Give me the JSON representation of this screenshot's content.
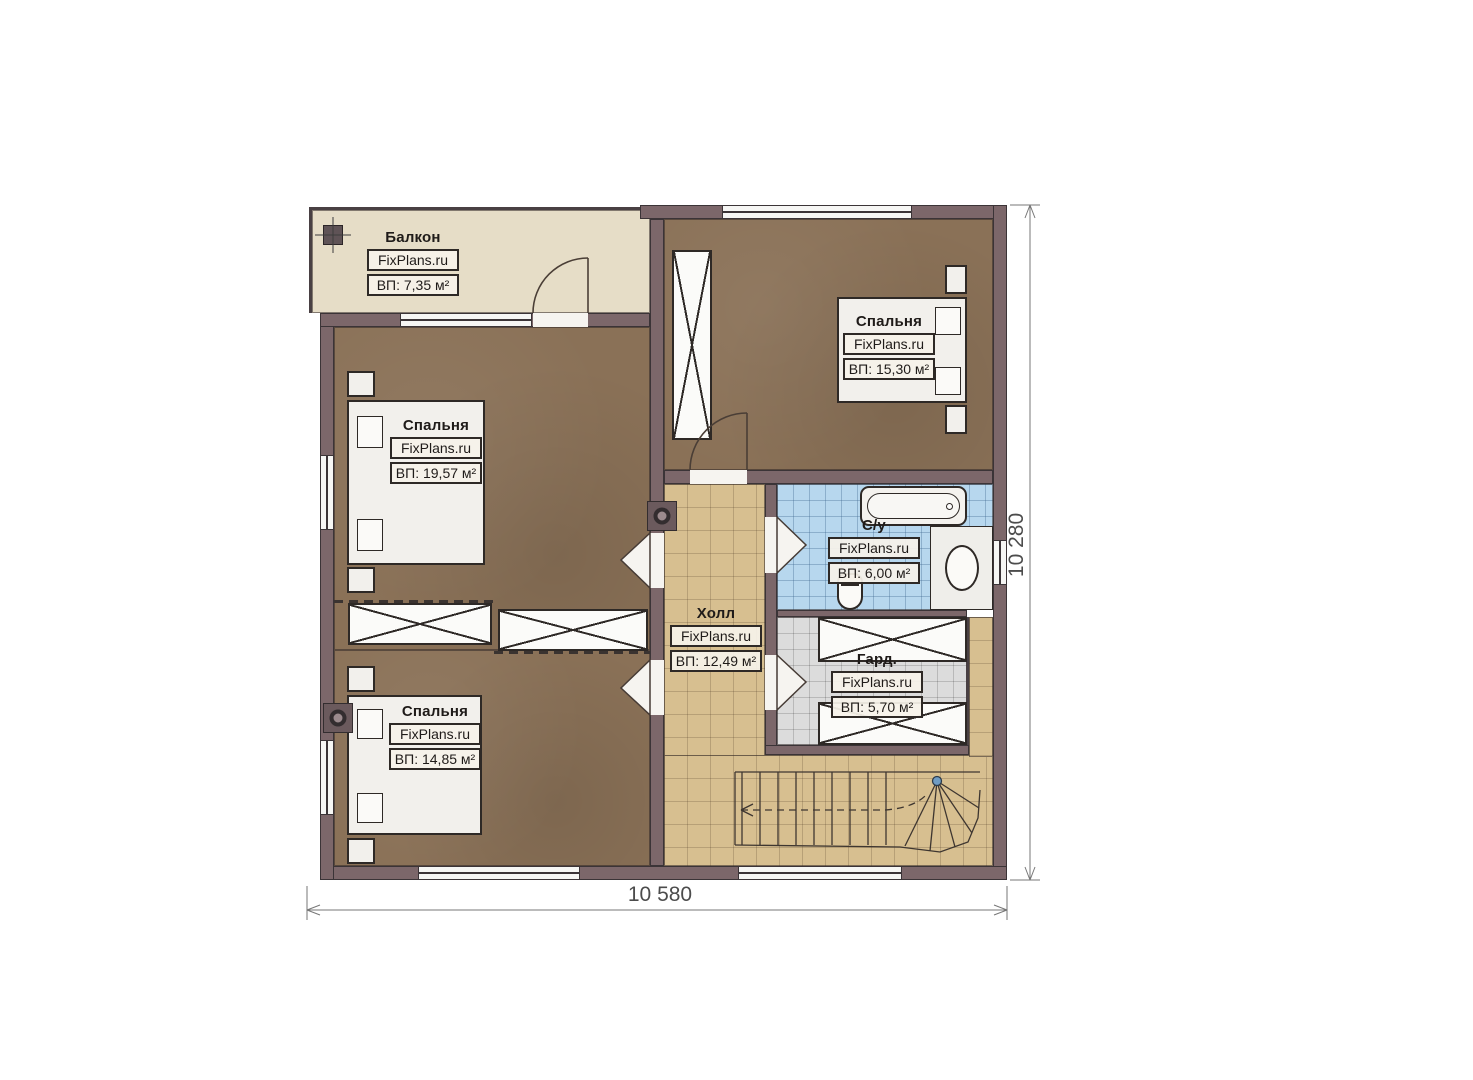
{
  "plan_title": "Floor plan — second floor",
  "brand": "FixPlans.ru",
  "rooms": [
    {
      "id": "balcony",
      "name": "Балкон",
      "brand": "FixPlans.ru",
      "area": "ВП: 7,35 м²"
    },
    {
      "id": "bedroom-top-left",
      "name": "Спальня",
      "brand": "FixPlans.ru",
      "area": "ВП: 19,57 м²"
    },
    {
      "id": "bedroom-top-right",
      "name": "Спальня",
      "brand": "FixPlans.ru",
      "area": "ВП: 15,30 м²"
    },
    {
      "id": "bedroom-bottom-left",
      "name": "Спальня",
      "brand": "FixPlans.ru",
      "area": "ВП: 14,85 м²"
    },
    {
      "id": "hall",
      "name": "Холл",
      "brand": "FixPlans.ru",
      "area": "ВП: 12,49 м²"
    },
    {
      "id": "bathroom",
      "name": "С/у",
      "brand": "FixPlans.ru",
      "area": "ВП: 6,00 м²"
    },
    {
      "id": "wardrobe",
      "name": "Гард.",
      "brand": "FixPlans.ru",
      "area": "ВП: 5,70 м²"
    }
  ],
  "dimensions": {
    "width": "10 580",
    "height": "10 280"
  },
  "colors": {
    "wall": "#7c676a",
    "bedroom_floor": "#8a7157",
    "hall_floor": "#d7bf90",
    "bath_floor": "#b7d7ee",
    "wardrobe_floor": "#dcdcdc",
    "balcony_floor": "#e6ddc7",
    "stair_pole": "#6f9cc4"
  }
}
